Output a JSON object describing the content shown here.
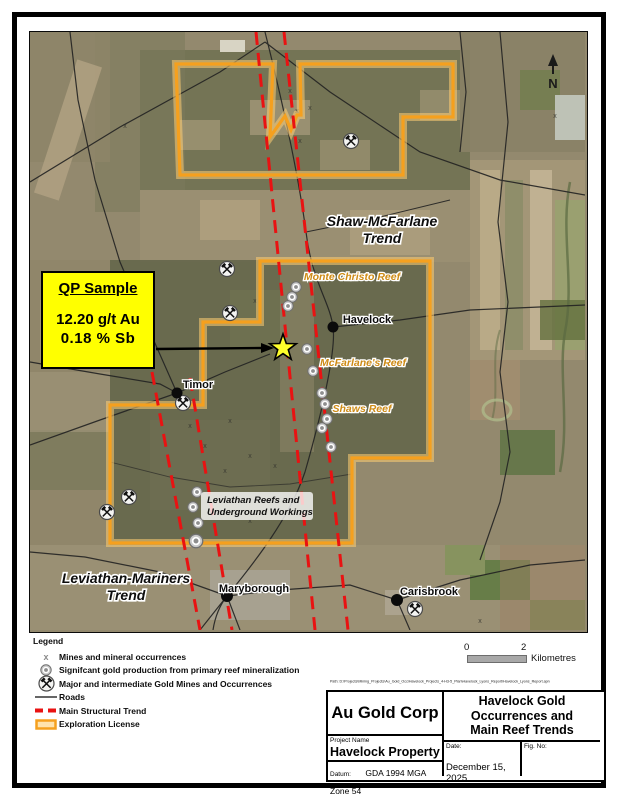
{
  "map": {
    "north_label": "N",
    "trends": [
      {
        "line1": "Shaw-McFarlane",
        "line2": "Trend"
      },
      {
        "line1": "Leviathan-Mariners",
        "line2": "Trend"
      }
    ],
    "reefs": [
      "Monte Christo Reef",
      "McFarlane's Reef",
      "Shaws Reef"
    ],
    "towns": [
      "Havelock",
      "Timor",
      "Maryborough",
      "Carisbrook"
    ],
    "workings": {
      "line1": "Leviathan Reefs and",
      "line2": "Underground Workings"
    },
    "qp_callout": {
      "title": "QP Sample",
      "assay1": "12.20 g/t Au",
      "assay2": "0.18  % Sb"
    }
  },
  "legend": {
    "title": "Legend",
    "items": [
      {
        "label": "Mines and mineral occurrences"
      },
      {
        "label": "Signifcant gold production from primary reef mineralization"
      },
      {
        "label": "Major and intermediate Gold Mines and Occurrences"
      },
      {
        "label": "Roads"
      },
      {
        "label": "Main Structural Trend"
      },
      {
        "label": "Exploration License"
      }
    ]
  },
  "scale_bar": {
    "start": "0",
    "end": "2",
    "unit": "Kilometres"
  },
  "title_block": {
    "path_note": "Path: D:\\Projects\\Mining_Projects\\Au_Gold_Occ\\Havelock_Projects_4-H3-5_Plan\\Havelock_Lyons_Report\\Havelock_Lyons_Report.apn",
    "company": "Au Gold Corp",
    "figure_title": "Havelock Gold Occurrences and Main Reef Trends",
    "project_name_label": "Project Name",
    "project_name": "Havelock Property",
    "datum_label": "Datum:",
    "datum": "GDA 1994 MGA Zone 54",
    "date_label": "Date:",
    "date": "December 15, 2025",
    "fig_no_label": "Fig. No:"
  },
  "colors": {
    "license_orange": "#F5A01E",
    "trend_red": "#E91212",
    "callout_yellow": "#FFFF00",
    "reef_label_gold": "#CE8B15"
  }
}
